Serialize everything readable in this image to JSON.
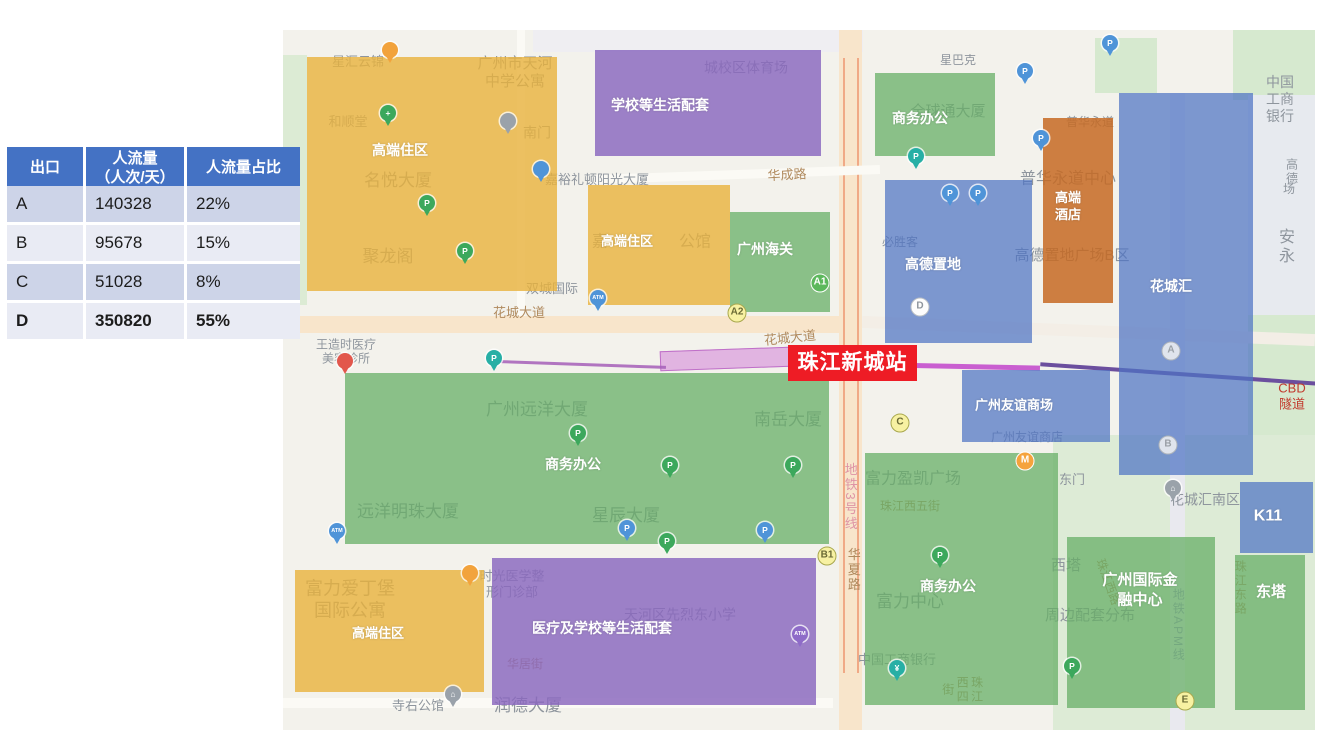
{
  "table": {
    "headers": [
      "出口",
      "人流量\n（人次/天）",
      "人流量占比"
    ],
    "rows": [
      {
        "exit": "A",
        "flow": "140328",
        "share": "22%",
        "bold": false
      },
      {
        "exit": "B",
        "flow": "95678",
        "share": "15%",
        "bold": false
      },
      {
        "exit": "C",
        "flow": "51028",
        "share": "8%",
        "bold": false
      },
      {
        "exit": "D",
        "flow": "350820",
        "share": "55%",
        "bold": true
      }
    ]
  },
  "station": {
    "label": "珠江新城站",
    "color": "#EE1C25"
  },
  "legend_colors": {
    "residential": "rgba(233,178,60,0.8)",
    "school_medical": "rgba(137,103,190,0.82)",
    "office": "rgba(103,175,103,0.75)",
    "commercial": "rgba(78,115,196,0.72)",
    "hotel": "rgba(198,106,35,0.85)"
  },
  "map": {
    "patches": [
      {
        "n": "park-left",
        "x": 0,
        "y": 25,
        "w": 24,
        "h": 250,
        "c": "#DCEBD4"
      },
      {
        "n": "park-topright",
        "x": 950,
        "y": 0,
        "w": 82,
        "h": 70,
        "c": "#D6E9CF"
      },
      {
        "n": "block-anyong",
        "x": 965,
        "y": 65,
        "w": 67,
        "h": 220,
        "c": "#E7EAEF"
      },
      {
        "n": "park-right",
        "x": 965,
        "y": 285,
        "w": 67,
        "h": 190,
        "c": "#D6E9CF"
      },
      {
        "n": "park-southeast",
        "x": 770,
        "y": 405,
        "w": 262,
        "h": 295,
        "c": "#DDEBD6"
      },
      {
        "n": "park-north",
        "x": 812,
        "y": 8,
        "w": 62,
        "h": 55,
        "c": "#D6E9CF"
      },
      {
        "n": "block-top",
        "x": 250,
        "y": 0,
        "w": 330,
        "h": 22,
        "c": "#EFEEF2"
      }
    ],
    "roads": [
      {
        "n": "huacheng-avenue",
        "x": 0,
        "y": 286,
        "w": 579,
        "h": 17,
        "c": "#F8E5CB"
      },
      {
        "n": "huaxia-road",
        "x": 556,
        "y": 0,
        "w": 23,
        "h": 700,
        "c": "#F8E5CB"
      },
      {
        "n": "overpass-stripe-1",
        "x": 560,
        "y": 28,
        "w": 2,
        "h": 615,
        "c": "#F0A986"
      },
      {
        "n": "overpass-stripe-2",
        "x": 574,
        "y": 28,
        "w": 2,
        "h": 615,
        "c": "#F0A986"
      },
      {
        "n": "huacheng-avenue-east",
        "x": 579,
        "y": 295,
        "w": 453,
        "h": 12,
        "c": "#F3EEE6",
        "r": 2.3
      },
      {
        "n": "huacheng-road",
        "x": 312,
        "y": 140,
        "w": 285,
        "h": 9,
        "c": "#FBFAF5",
        "r": -2
      },
      {
        "n": "apm-corridor",
        "x": 887,
        "y": 63,
        "w": 15,
        "h": 637,
        "c": "#E9E9EF"
      },
      {
        "n": "siyou-road",
        "x": 0,
        "y": 668,
        "w": 550,
        "h": 10,
        "c": "#FBFAF5"
      },
      {
        "n": "north-road",
        "x": 234,
        "y": 0,
        "w": 8,
        "h": 286,
        "c": "#FBFAF5"
      }
    ],
    "lines": [
      {
        "n": "line5-station-band",
        "x": 377,
        "y": 319,
        "w": 128,
        "h": 18,
        "c": "rgba(214,138,218,0.6)",
        "r": -2,
        "bd": "#BF6FC8"
      },
      {
        "n": "line5-west",
        "x": 217,
        "y": 333,
        "w": 166,
        "h": 3,
        "c": "rgba(165,95,184,0.85)",
        "r": 2
      },
      {
        "n": "line5-mid",
        "x": 505,
        "y": 333,
        "w": 252,
        "h": 5,
        "c": "#C95FD0",
        "r": 1.2
      },
      {
        "n": "line5-east",
        "x": 757,
        "y": 342,
        "w": 278,
        "h": 4,
        "c": "#6B4F9E",
        "r": 4
      }
    ],
    "regions": [
      {
        "n": "residential-nw",
        "type": "residential",
        "label": "高端住区",
        "x": 24,
        "y": 27,
        "w": 250,
        "h": 234,
        "lx": 117,
        "ly": 120,
        "fs": 14
      },
      {
        "n": "school-north",
        "type": "school_medical",
        "label": "学校等生活配套",
        "x": 312,
        "y": 20,
        "w": 226,
        "h": 106,
        "lx": 377,
        "ly": 75,
        "fs": 14
      },
      {
        "n": "residential-jiayu",
        "type": "residential",
        "label": "高端住区",
        "x": 305,
        "y": 155,
        "w": 142,
        "h": 120,
        "lx": 344,
        "ly": 212,
        "fs": 13
      },
      {
        "n": "customs",
        "type": "office",
        "label": "广州海关",
        "x": 447,
        "y": 182,
        "w": 100,
        "h": 100,
        "lx": 482,
        "ly": 219,
        "fs": 14
      },
      {
        "n": "office-north",
        "type": "office",
        "label": "商务办公",
        "x": 592,
        "y": 43,
        "w": 120,
        "h": 83,
        "lx": 637,
        "ly": 88,
        "fs": 14
      },
      {
        "n": "hotel",
        "type": "hotel",
        "label": "高端\n酒店",
        "x": 760,
        "y": 88,
        "w": 70,
        "h": 185,
        "lx": 785,
        "ly": 177,
        "fs": 13
      },
      {
        "n": "gtland-plaza",
        "type": "commercial",
        "label": "高德置地",
        "x": 602,
        "y": 150,
        "w": 147,
        "h": 163,
        "lx": 650,
        "ly": 234,
        "fs": 14
      },
      {
        "n": "huachenghui",
        "type": "commercial",
        "label": "花城汇",
        "x": 836,
        "y": 63,
        "w": 134,
        "h": 382,
        "lx": 888,
        "ly": 256,
        "fs": 14
      },
      {
        "n": "friendship-store",
        "type": "commercial",
        "label": "广州友谊商场",
        "x": 679,
        "y": 340,
        "w": 148,
        "h": 72,
        "lx": 731,
        "ly": 376,
        "fs": 13
      },
      {
        "n": "office-main",
        "type": "office",
        "label": "商务办公",
        "x": 62,
        "y": 343,
        "w": 484,
        "h": 171,
        "lx": 290,
        "ly": 434,
        "fs": 14
      },
      {
        "n": "medical-school-south",
        "type": "school_medical",
        "label": "医疗及学校等生活配套",
        "x": 209,
        "y": 528,
        "w": 324,
        "h": 147,
        "lx": 319,
        "ly": 598,
        "fs": 14
      },
      {
        "n": "residential-sw",
        "type": "residential",
        "label": "高端住区",
        "x": 12,
        "y": 540,
        "w": 189,
        "h": 122,
        "lx": 95,
        "ly": 604,
        "fs": 13
      },
      {
        "n": "office-south",
        "type": "office",
        "label": "商务办公",
        "x": 582,
        "y": 423,
        "w": 193,
        "h": 252,
        "lx": 665,
        "ly": 556,
        "fs": 14
      },
      {
        "n": "ifc",
        "type": "office",
        "label": "广州国际金\n融中心",
        "x": 784,
        "y": 507,
        "w": 148,
        "h": 171,
        "lx": 857,
        "ly": 560,
        "fs": 15
      },
      {
        "n": "east-tower",
        "type": "office",
        "label": "东塔",
        "x": 952,
        "y": 525,
        "w": 70,
        "h": 155,
        "lx": 988,
        "ly": 562,
        "fs": 15
      },
      {
        "n": "k11",
        "type": "commercial",
        "label": "K11",
        "x": 957,
        "y": 452,
        "w": 73,
        "h": 71,
        "lx": 985,
        "ly": 487,
        "fs": 16
      }
    ],
    "labels": [
      {
        "t": "星汇云锦",
        "x": 75,
        "y": 32,
        "s": 13,
        "c": "g"
      },
      {
        "t": "广州市天河\n中学公寓",
        "x": 232,
        "y": 43,
        "s": 15,
        "c": "g"
      },
      {
        "t": "和顺堂",
        "x": 65,
        "y": 92,
        "s": 13,
        "c": "g"
      },
      {
        "t": "南门",
        "x": 254,
        "y": 103,
        "s": 14,
        "c": "g"
      },
      {
        "t": "名悦大厦",
        "x": 115,
        "y": 151,
        "s": 17,
        "c": "g"
      },
      {
        "t": "嘉裕礼顿阳光大厦",
        "x": 314,
        "y": 150,
        "s": 13,
        "c": "g"
      },
      {
        "t": "华成路",
        "x": 504,
        "y": 145,
        "s": 13,
        "c": "b",
        "r": -3
      },
      {
        "t": "城校区体育场",
        "x": 463,
        "y": 38,
        "s": 14,
        "c": "g"
      },
      {
        "t": "聚龙阁",
        "x": 105,
        "y": 227,
        "s": 17,
        "c": "g"
      },
      {
        "t": "双城国际",
        "x": 269,
        "y": 259,
        "s": 13,
        "c": "g"
      },
      {
        "t": "嘉",
        "x": 317,
        "y": 212,
        "s": 16,
        "c": "g"
      },
      {
        "t": "公馆",
        "x": 412,
        "y": 212,
        "s": 16,
        "c": "g"
      },
      {
        "t": "星巴克",
        "x": 675,
        "y": 30,
        "s": 12,
        "c": "g"
      },
      {
        "t": "全球通大厦",
        "x": 665,
        "y": 82,
        "s": 15,
        "c": "g"
      },
      {
        "t": "必胜客",
        "x": 617,
        "y": 212,
        "s": 12,
        "c": "g"
      },
      {
        "t": "普华永道",
        "x": 807,
        "y": 92,
        "s": 12,
        "c": "g"
      },
      {
        "t": "普华永道中心",
        "x": 785,
        "y": 149,
        "s": 16,
        "c": "g"
      },
      {
        "t": "高德置地广场B区",
        "x": 789,
        "y": 226,
        "s": 15,
        "c": "g"
      },
      {
        "t": "中国工商银行",
        "x": 997,
        "y": 69,
        "s": 14,
        "c": "g"
      },
      {
        "t": "高德",
        "x": 1009,
        "y": 142,
        "s": 12,
        "c": "g"
      },
      {
        "t": "场",
        "x": 1006,
        "y": 159,
        "s": 12,
        "c": "g"
      },
      {
        "t": "安永",
        "x": 1004,
        "y": 217,
        "s": 16,
        "c": "g"
      },
      {
        "t": "花城大道",
        "x": 236,
        "y": 283,
        "s": 13,
        "c": "b"
      },
      {
        "t": "花城大道",
        "x": 507,
        "y": 308,
        "s": 13,
        "c": "b",
        "r": -6
      },
      {
        "t": "王造时医疗\n美容诊所",
        "x": 63,
        "y": 322,
        "s": 12,
        "c": "g"
      },
      {
        "t": "广州远洋大厦",
        "x": 254,
        "y": 380,
        "s": 17,
        "c": "g"
      },
      {
        "t": "南岳大厦",
        "x": 505,
        "y": 390,
        "s": 17,
        "c": "g"
      },
      {
        "t": "远洋明珠大厦",
        "x": 125,
        "y": 482,
        "s": 17,
        "c": "g"
      },
      {
        "t": "星辰大厦",
        "x": 343,
        "y": 486,
        "s": 17,
        "c": "g"
      },
      {
        "t": "地铁3号线",
        "x": 567,
        "y": 467,
        "s": 13,
        "c": "p",
        "vt": 1
      },
      {
        "t": "华夏路",
        "x": 570,
        "y": 540,
        "s": 13,
        "c": "b",
        "vt": 1
      },
      {
        "t": "广州友谊商店",
        "x": 744,
        "y": 407,
        "s": 12,
        "c": "g"
      },
      {
        "t": "CBD隧道",
        "x": 1009,
        "y": 366,
        "s": 13,
        "c": "r"
      },
      {
        "t": "富力爱丁堡\n国际公寓",
        "x": 67,
        "y": 570,
        "s": 18,
        "c": "g"
      },
      {
        "t": "时光医学整\n形门诊部",
        "x": 229,
        "y": 554,
        "s": 13,
        "c": "g"
      },
      {
        "t": "天河区先烈东小学",
        "x": 397,
        "y": 585,
        "s": 14,
        "c": "g"
      },
      {
        "t": "华居街",
        "x": 242,
        "y": 634,
        "s": 12,
        "c": "b"
      },
      {
        "t": "润德大厦",
        "x": 245,
        "y": 676,
        "s": 17,
        "c": "g"
      },
      {
        "t": "寺右公馆",
        "x": 135,
        "y": 676,
        "s": 13,
        "c": "g"
      },
      {
        "t": "富力盈凯广场",
        "x": 630,
        "y": 449,
        "s": 16,
        "c": "g"
      },
      {
        "t": "珠江西五街",
        "x": 627,
        "y": 476,
        "s": 12,
        "c": "b"
      },
      {
        "t": "富力中心",
        "x": 627,
        "y": 572,
        "s": 17,
        "c": "g"
      },
      {
        "t": "中国工商银行",
        "x": 614,
        "y": 630,
        "s": 13,
        "c": "g"
      },
      {
        "t": "珠江西四街",
        "x": 679,
        "y": 660,
        "s": 12,
        "c": "b",
        "vt": 1
      },
      {
        "t": "东门",
        "x": 789,
        "y": 450,
        "s": 13,
        "c": "g"
      },
      {
        "t": "西塔",
        "x": 783,
        "y": 536,
        "s": 15,
        "c": "g"
      },
      {
        "t": "周边配套分布",
        "x": 807,
        "y": 586,
        "s": 15,
        "c": "g"
      },
      {
        "t": "花城汇南区",
        "x": 922,
        "y": 470,
        "s": 14,
        "c": "g"
      },
      {
        "t": "珠江西路",
        "x": 825,
        "y": 552,
        "s": 12,
        "c": "b",
        "r": 70
      },
      {
        "t": "珠江东路",
        "x": 957,
        "y": 558,
        "s": 12,
        "c": "b",
        "vt": 1
      },
      {
        "t": "地铁APM线",
        "x": 895,
        "y": 595,
        "s": 12,
        "c": "v",
        "vt": 1
      }
    ],
    "badges": [
      {
        "t": "A1",
        "st": "green",
        "x": 537,
        "y": 253
      },
      {
        "t": "A2",
        "st": "yellow",
        "x": 454,
        "y": 283
      },
      {
        "t": "B1",
        "st": "yellow",
        "x": 544,
        "y": 526
      },
      {
        "t": "C",
        "st": "yellow",
        "x": 617,
        "y": 393
      },
      {
        "t": "D",
        "st": "white",
        "x": 637,
        "y": 277
      },
      {
        "t": "A",
        "st": "gray",
        "x": 888,
        "y": 321
      },
      {
        "t": "B",
        "st": "gray",
        "x": 885,
        "y": 415
      },
      {
        "t": "E",
        "st": "yellow",
        "x": 902,
        "y": 671
      },
      {
        "t": "M",
        "st": "orange",
        "x": 742,
        "y": 431
      }
    ],
    "pins": [
      {
        "l": "P",
        "c": "green",
        "x": 144,
        "y": 185
      },
      {
        "l": "P",
        "c": "green",
        "x": 182,
        "y": 233
      },
      {
        "l": "P",
        "c": "teal",
        "x": 211,
        "y": 340
      },
      {
        "l": "P",
        "c": "green",
        "x": 295,
        "y": 415
      },
      {
        "l": "P",
        "c": "green",
        "x": 387,
        "y": 447
      },
      {
        "l": "P",
        "c": "green",
        "x": 510,
        "y": 447
      },
      {
        "l": "P",
        "c": "blue",
        "x": 344,
        "y": 510
      },
      {
        "l": "P",
        "c": "blue",
        "x": 482,
        "y": 512
      },
      {
        "l": "P",
        "c": "green",
        "x": 657,
        "y": 537
      },
      {
        "l": "P",
        "c": "teal",
        "x": 633,
        "y": 138
      },
      {
        "l": "P",
        "c": "blue",
        "x": 667,
        "y": 175
      },
      {
        "l": "P",
        "c": "blue",
        "x": 695,
        "y": 175
      },
      {
        "l": "P",
        "c": "blue",
        "x": 742,
        "y": 53
      },
      {
        "l": "P",
        "c": "blue",
        "x": 758,
        "y": 120
      },
      {
        "l": "ATM",
        "c": "blue",
        "x": 54,
        "y": 513
      },
      {
        "l": "ATM",
        "c": "blue",
        "x": 315,
        "y": 280
      },
      {
        "l": "ATM",
        "c": "purple",
        "x": 517,
        "y": 616
      },
      {
        "l": "",
        "c": "red",
        "x": 62,
        "y": 343
      },
      {
        "l": "¥",
        "c": "teal",
        "x": 614,
        "y": 650
      },
      {
        "l": "+",
        "c": "green",
        "x": 105,
        "y": 95
      },
      {
        "l": "",
        "c": "gray",
        "x": 225,
        "y": 103
      },
      {
        "l": "",
        "c": "blue",
        "x": 258,
        "y": 151
      },
      {
        "l": "",
        "c": "orange",
        "x": 107,
        "y": 32
      },
      {
        "l": "",
        "c": "orange",
        "x": 187,
        "y": 555
      },
      {
        "l": "⌂",
        "c": "gray",
        "x": 170,
        "y": 676
      },
      {
        "l": "⌂",
        "c": "gray",
        "x": 890,
        "y": 470
      },
      {
        "l": "P",
        "c": "green",
        "x": 384,
        "y": 523
      },
      {
        "l": "P",
        "c": "blue",
        "x": 827,
        "y": 25
      },
      {
        "l": "P",
        "c": "green",
        "x": 789,
        "y": 648
      }
    ]
  }
}
